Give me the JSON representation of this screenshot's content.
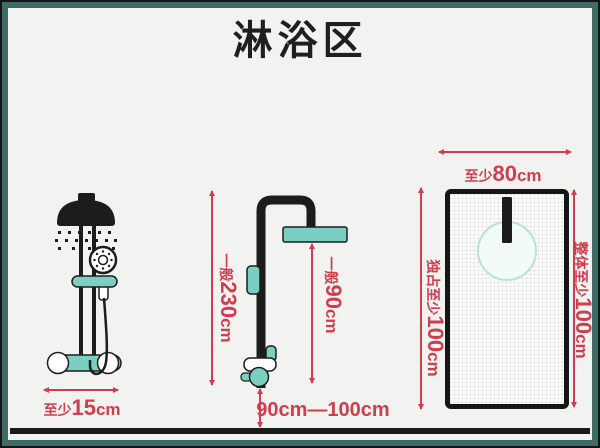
{
  "title": "淋浴区",
  "colors": {
    "frame_teal": "#3f6b66",
    "background": "#f2f2f0",
    "fixture_teal": "#7bcfc2",
    "dimension_red": "#cf3e4d",
    "ink_black": "#1c1c1c"
  },
  "left_diagram": {
    "icon": "hand-shower-front-view",
    "width_label": {
      "prefix": "至少",
      "value": "15",
      "unit": "cm"
    }
  },
  "middle_diagram": {
    "icon": "shower-column-side-view",
    "total_height_label": {
      "prefix": "一般",
      "value": "230",
      "unit": "cm"
    },
    "head_height_label": {
      "prefix": "一般",
      "value": "90",
      "unit": "cm"
    },
    "valve_height_label": {
      "value": "90cm—100cm"
    }
  },
  "right_diagram": {
    "icon": "shower-area-top-view",
    "width_label": {
      "prefix": "至少",
      "value": "80",
      "unit": "cm"
    },
    "exclusive_depth_label": {
      "prefix": "独占至少",
      "value": "100",
      "unit": "cm"
    },
    "overall_depth_label": {
      "prefix": "整体至少",
      "value": "100",
      "unit": "cm"
    }
  }
}
